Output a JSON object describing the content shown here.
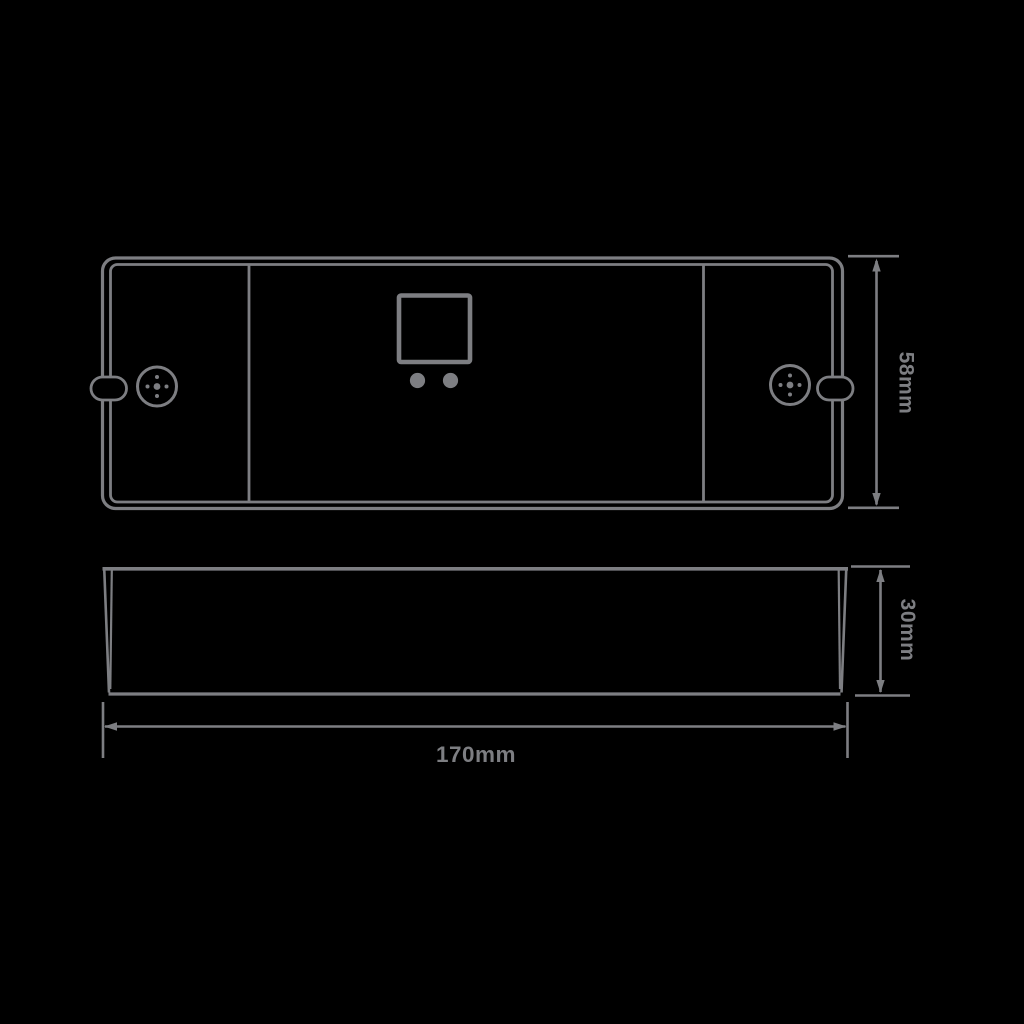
{
  "diagram": {
    "labels": {
      "width": "170mm",
      "height": "58mm",
      "depth": "30mm"
    },
    "colors": {
      "line": "#7d7e82",
      "background": "#000000"
    }
  }
}
